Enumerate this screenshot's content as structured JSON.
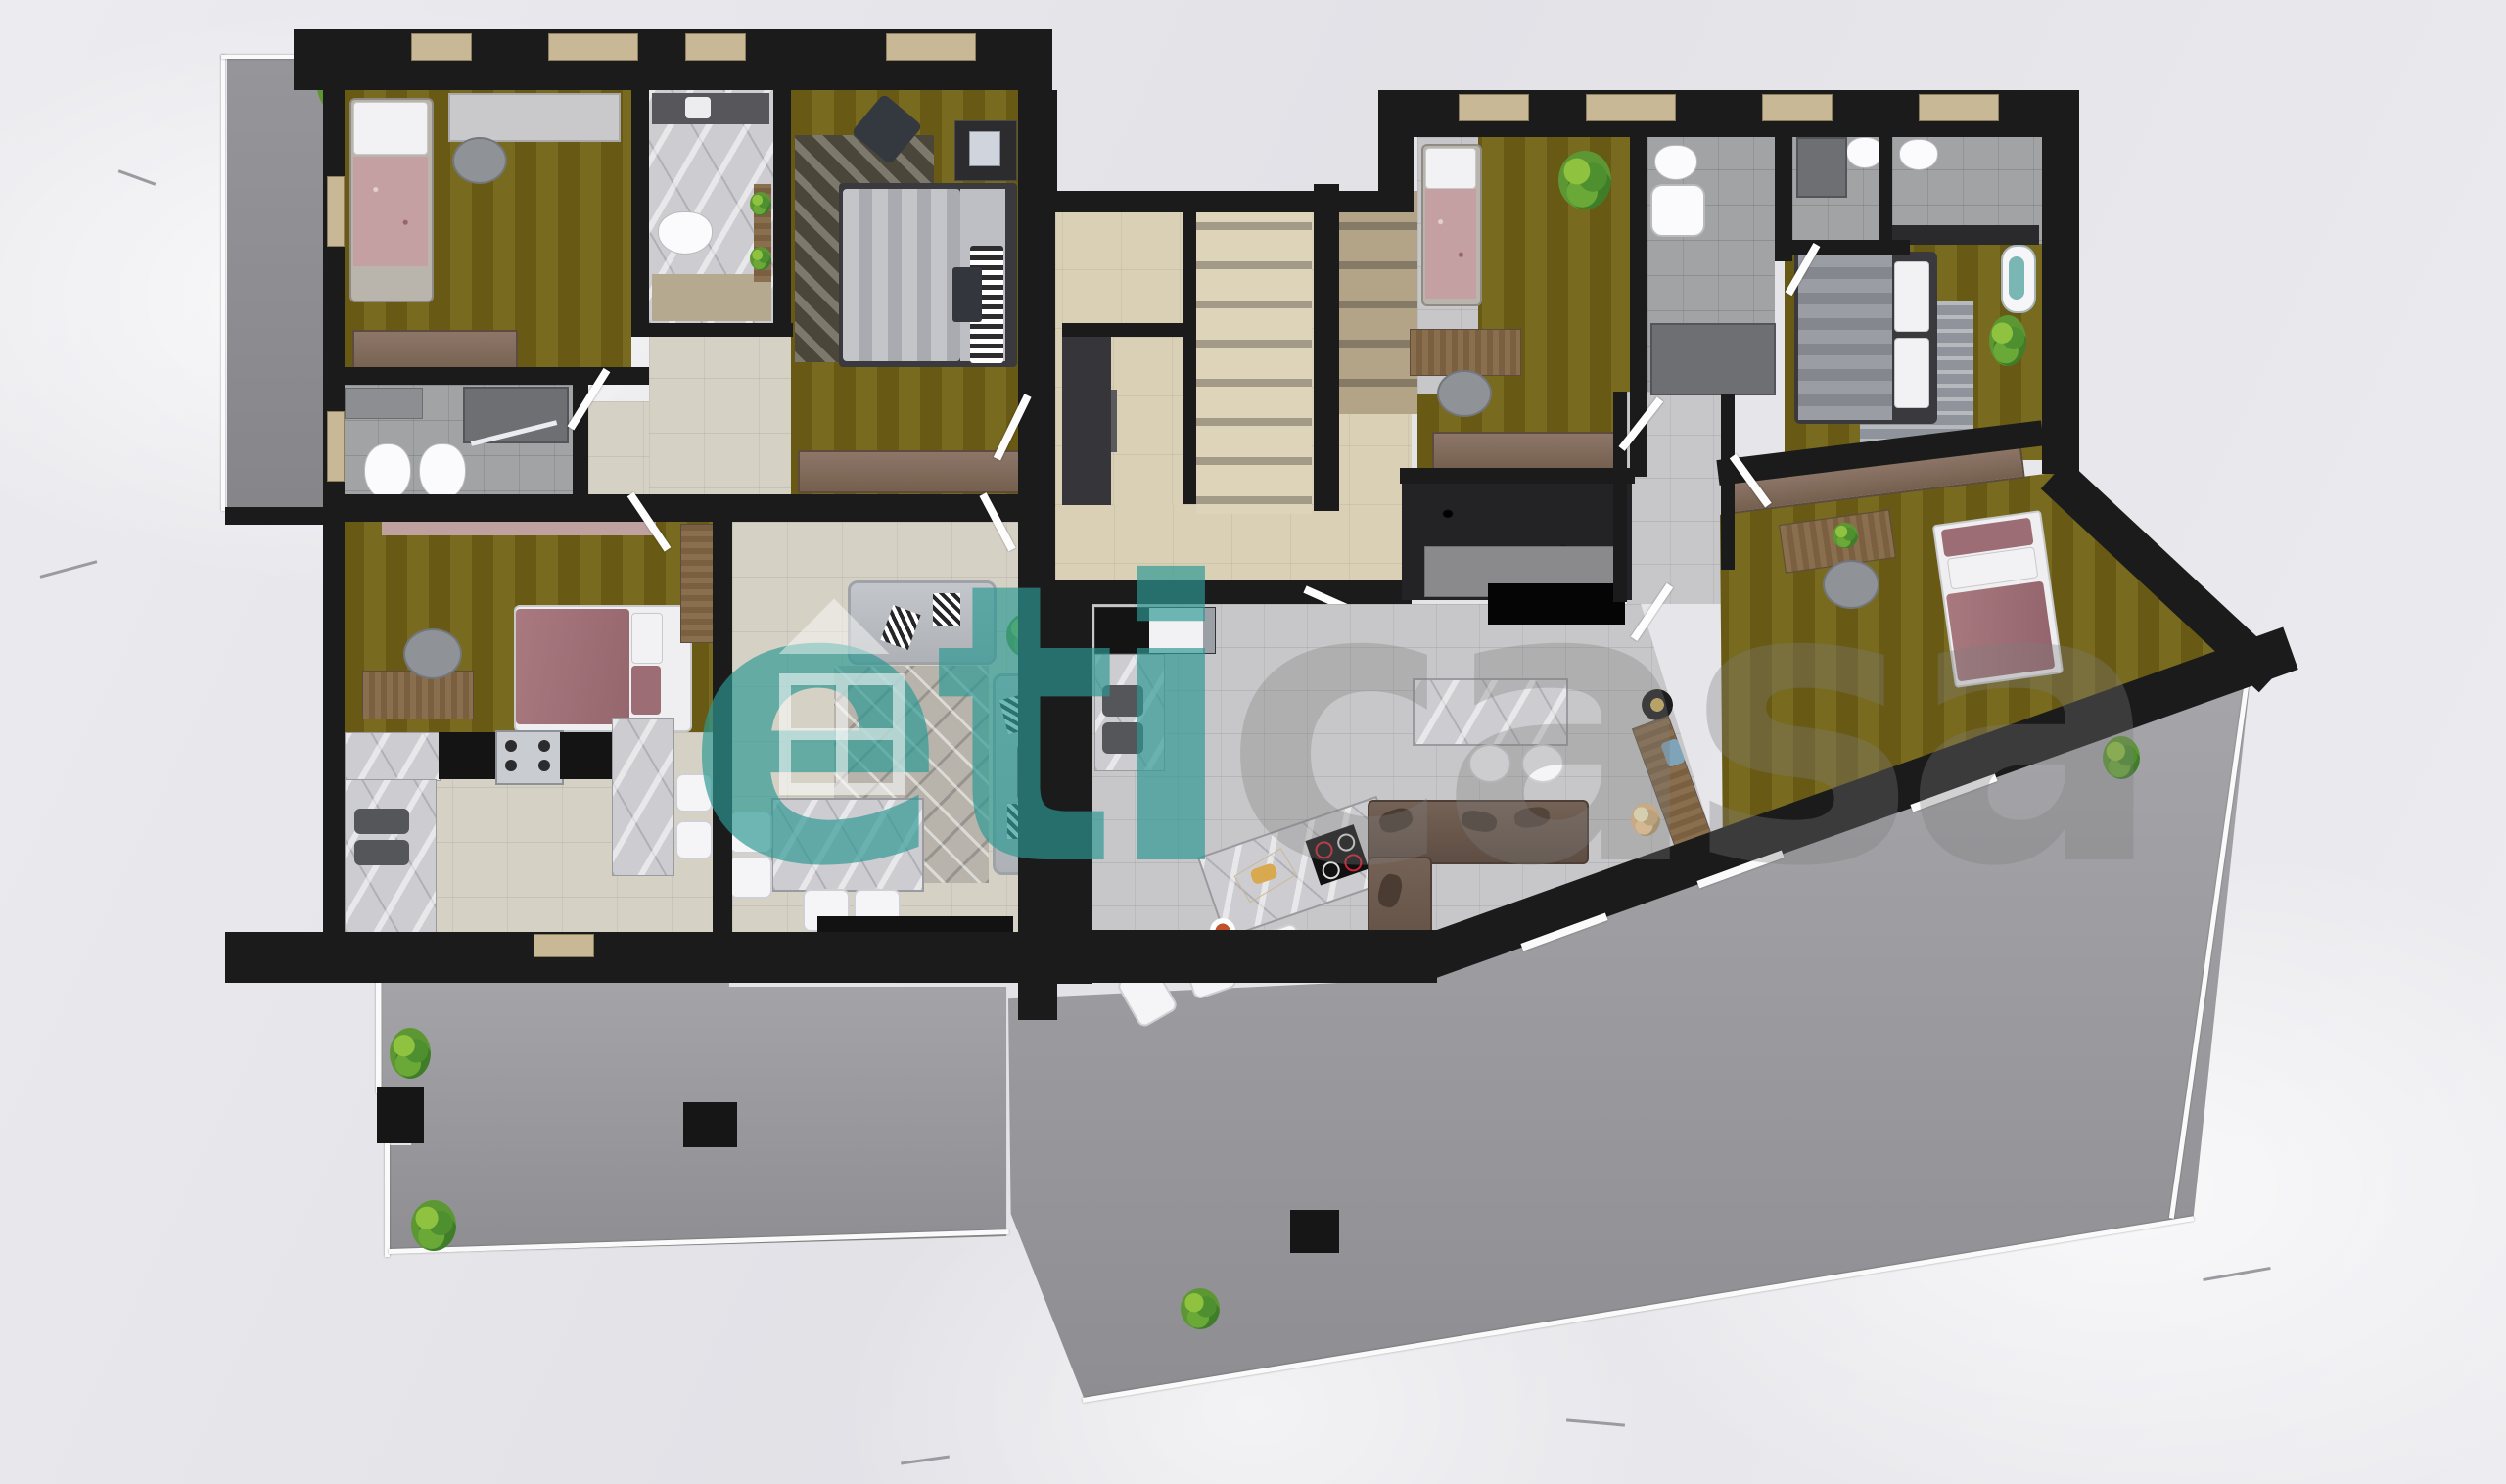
{
  "watermark": {
    "primary_text": "eti",
    "secondary_text": "casa",
    "primary_color": "#2c9894",
    "secondary_color": "#7d7d7d",
    "icon": "house-icon"
  },
  "palette": {
    "wall": "#1b1b1b",
    "olive": "#70611a",
    "beige": "#d6d1c5",
    "stair": "#d9d0b6",
    "graytile": "#a2a3a5",
    "terrace": "#98989c",
    "marble": "#cdcdd1",
    "snow": "#e9e9ec",
    "wood": "#8a6f4e",
    "sofa_gray": "#b7babe",
    "sofa_brown": "#6d5b50",
    "bed_mauve": "#a87a80",
    "plant": "#5d9733",
    "wm_primary": "rgba(44,152,148,0.82)",
    "wm_secondary": "rgba(125,125,125,0.6)"
  }
}
